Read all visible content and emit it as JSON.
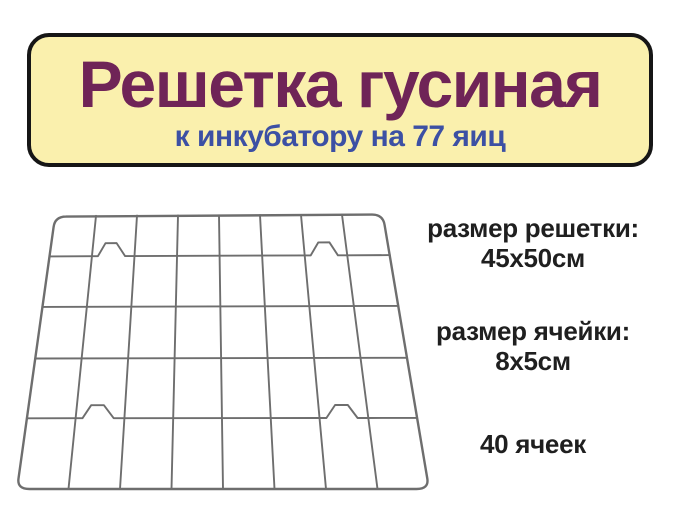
{
  "banner": {
    "title": "Решетка гусиная",
    "subtitle": "к инкубатору на 77 яиц",
    "bg_color": "#faf0ad",
    "border_color": "#161616",
    "title_color": "#6f2457",
    "subtitle_color": "#3c50a4"
  },
  "specs": [
    {
      "label": "размер решетки:",
      "value": "45x50см"
    },
    {
      "label": "размер ячейки:",
      "value": "8х5см"
    }
  ],
  "cell_count_text": "40 ячеек",
  "text_color": "#1f1f1f",
  "product_image": {
    "type": "wire-grid-sketch",
    "columns": 8,
    "rows": 5,
    "cell_count": 40,
    "spacer_bumps": 4,
    "wire_color": "#6e6e6e"
  }
}
